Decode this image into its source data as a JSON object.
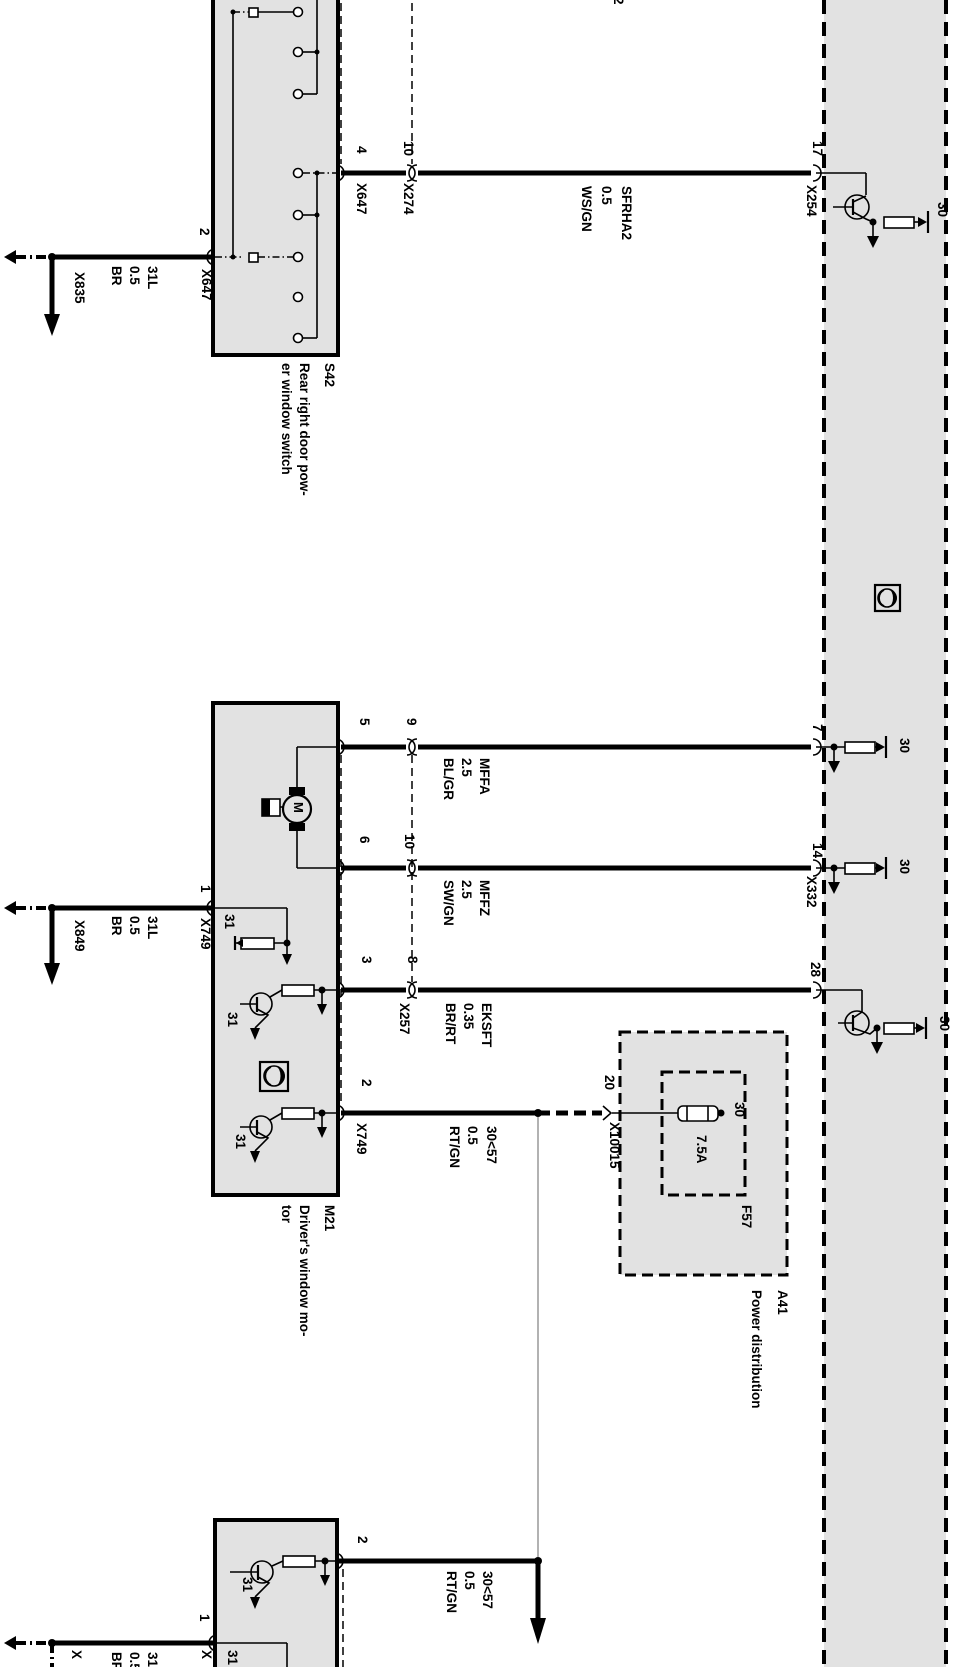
{
  "top_cut_pin": "2",
  "s42": {
    "id": "S42",
    "desc1": "Rear right door pow-",
    "desc2": "er window switch",
    "pin2": "2",
    "conn2": "X647",
    "pin4": "4",
    "conn4": "X647",
    "pin10": "10",
    "conn10": "X274"
  },
  "ground_top": {
    "conn": "X835",
    "wire": {
      "name": "31L",
      "gauge": "0.5",
      "color": "BR"
    }
  },
  "ground_mid": {
    "conn": "X849",
    "wire": {
      "name": "31L",
      "gauge": "0.5",
      "color": "BR"
    }
  },
  "wires": {
    "sfrha2": {
      "name": "SFRHA2",
      "gauge": "0.5",
      "color": "WS/GN"
    },
    "mffa": {
      "name": "MFFA",
      "gauge": "2.5",
      "color": "BL/GR"
    },
    "mffz": {
      "name": "MFFZ",
      "gauge": "2.5",
      "color": "SW/GN"
    },
    "eksft": {
      "name": "EKSFT",
      "gauge": "0.35",
      "color": "BR/RT"
    },
    "rtgn": {
      "name": "30<57",
      "gauge": "0.5",
      "color": "RT/GN"
    }
  },
  "module_column": {
    "pin17": "17",
    "conn17": "X254",
    "pin7": "7",
    "pin14": "14",
    "conn14": "X332",
    "pin28": "28",
    "t30": "30"
  },
  "m21": {
    "id": "M21",
    "desc1": "Driver's window mo-",
    "desc2": "tor",
    "motor": "M",
    "pin5": "5",
    "pin9": "9",
    "pin6": "6",
    "pin10": "10",
    "pin3": "3",
    "pin8": "8",
    "conn8": "X257",
    "pin1": "1",
    "conn1": "X749",
    "pin2": "2",
    "conn2": "X749",
    "t31": "31"
  },
  "a41": {
    "id": "A41",
    "desc": "Power distribution",
    "pin20": "20",
    "conn20": "X10015",
    "fuse_id": "F57",
    "fuse_rating": "7.5A",
    "t30": "30"
  },
  "bottom_module": {
    "pin2": "2",
    "wire": {
      "name": "30<57",
      "gauge": "0.5",
      "color": "RT/GN"
    },
    "t31": "31",
    "pin1": "1",
    "cut_conn_a": "X",
    "cut_conn_b": "X",
    "cut_t31": "31",
    "cut_wire": {
      "name": "31L",
      "gauge": "0.5",
      "color": "BR"
    }
  }
}
